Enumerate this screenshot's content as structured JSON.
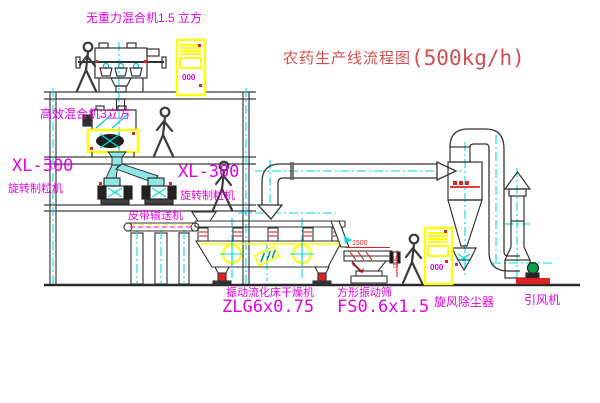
{
  "title": {
    "text": "农药生产线流程图",
    "capacity": "(500kg/h)"
  },
  "equipment": {
    "gravity_free_mixer": {
      "label": "无重力混合机1.5 立方"
    },
    "high_efficiency_mixer": {
      "label": "高效混合机3立方"
    },
    "granulator_left": {
      "model": "XL-300",
      "name": "旋转制粒机"
    },
    "granulator_right": {
      "model": "XL-300",
      "name": "旋转制粒机"
    },
    "belt_conveyor": {
      "name": "皮带输送机"
    },
    "fluid_bed_dryer": {
      "name": "振动流化床干燥机",
      "model": "ZLG6x0.75"
    },
    "vibrating_sieve": {
      "name": "方形振动筛",
      "model": "FS0.6x1.5"
    },
    "cyclone_dust_collector": {
      "name": "旋风除尘器"
    },
    "induced_draft_fan": {
      "name": "引风机"
    },
    "control_cabinet_top": {
      "display": "000"
    },
    "control_cabinet_bottom": {
      "display": "000"
    }
  },
  "dimensions": {
    "sieve_length": "1500",
    "sieve_height": "500"
  },
  "colors": {
    "line": "#3c3c3c",
    "centerline": "#00dcdc",
    "label_magenta": "#e303e3",
    "title_red": "#d05050",
    "accent_red": "#dd2222",
    "highlight_yellow": "#ffff00",
    "green": "#0aa14a",
    "background": "#ffffff"
  }
}
